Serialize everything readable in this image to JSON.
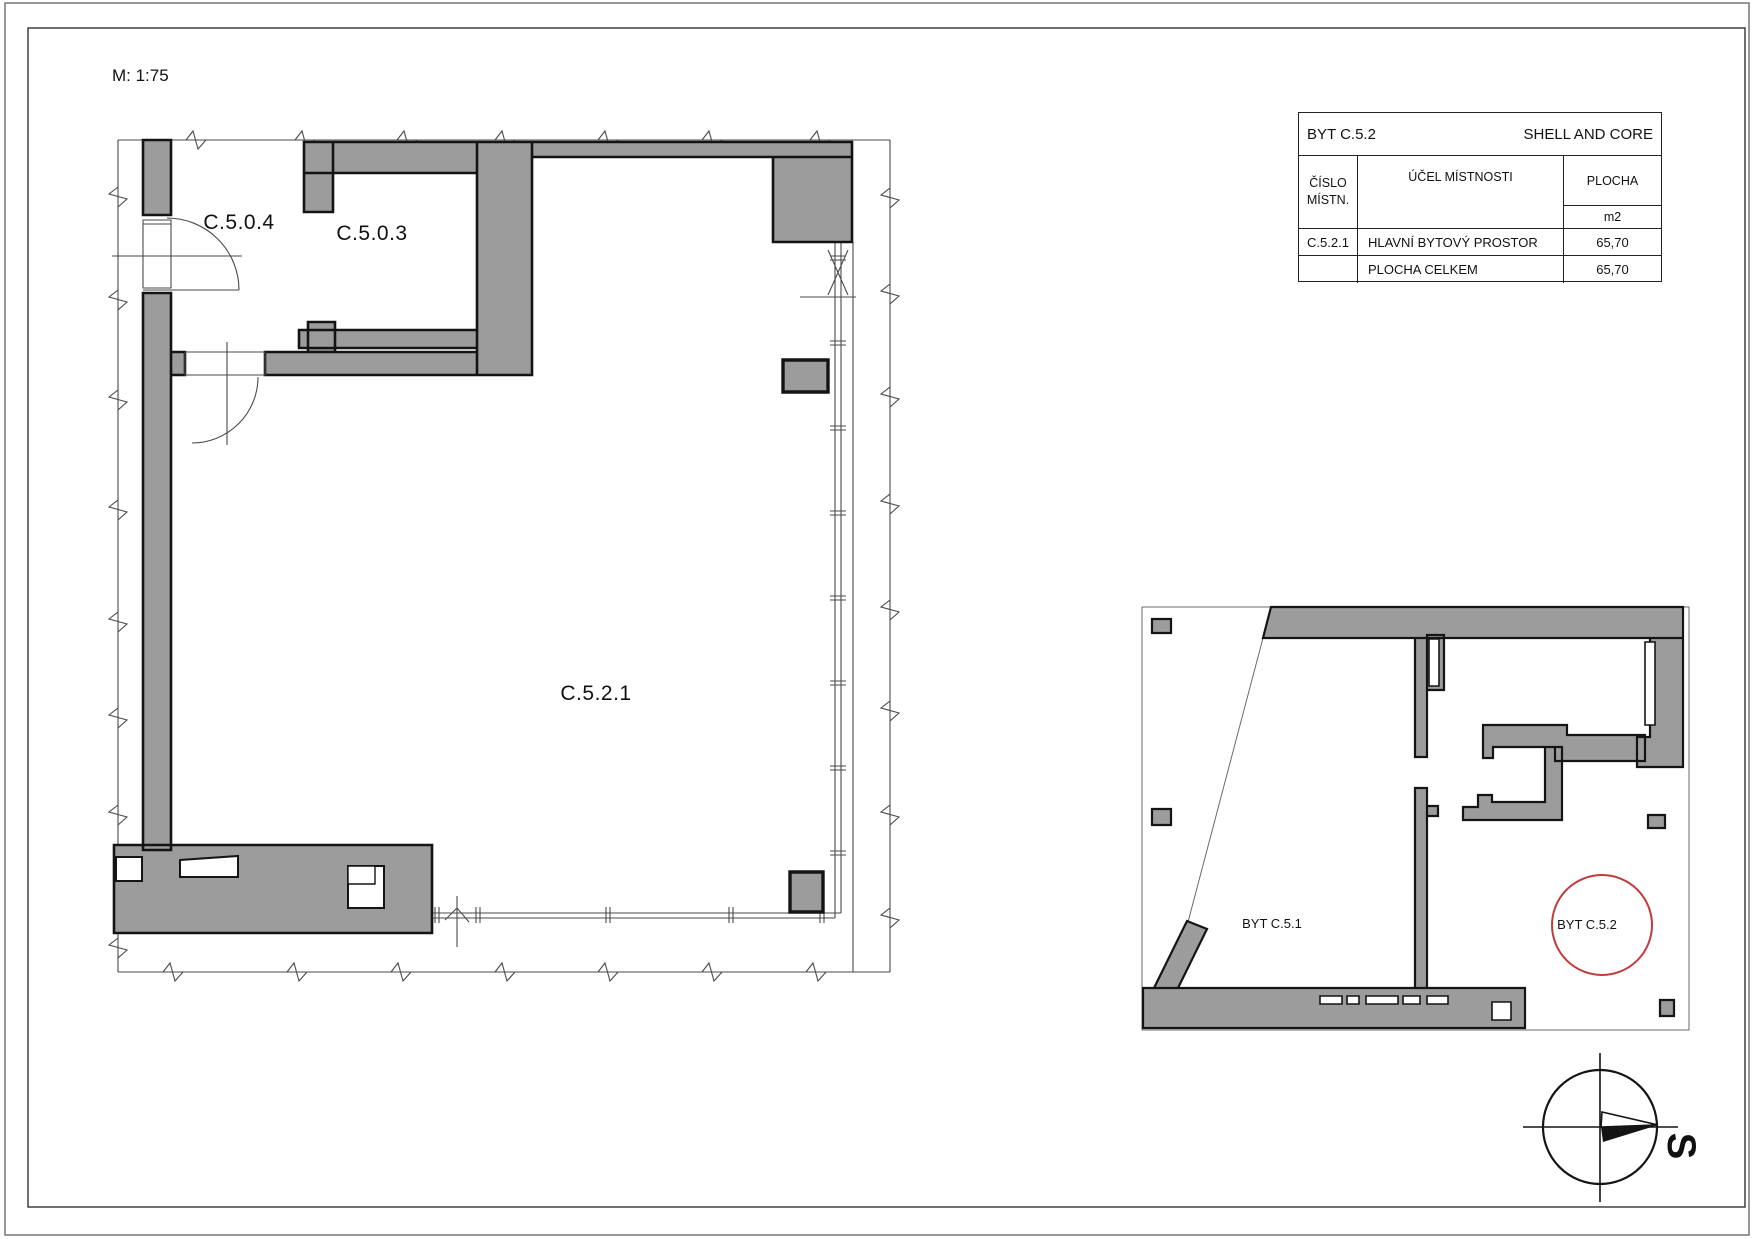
{
  "page": {
    "scale_label": "M: 1:75"
  },
  "colors": {
    "wall_fill": "#9c9c9c",
    "outline": "#141414",
    "thin_line": "#4a4a4a",
    "highlight_red": "#c23b3c"
  },
  "main_plan": {
    "rooms": [
      {
        "id": "C.5.0.4"
      },
      {
        "id": "C.5.0.3"
      },
      {
        "id": "C.5.2.1"
      }
    ]
  },
  "room_table": {
    "title_left": "BYT C.5.2",
    "title_right": "SHELL AND CORE",
    "col_number_line1": "ČÍSLO",
    "col_number_line2": "MÍSTN.",
    "col_purpose": "ÚČEL MÍSTNOSTI",
    "col_area": "PLOCHA",
    "col_area_unit": "m2",
    "rows": [
      {
        "number": "C.5.2.1",
        "purpose": "HLAVNÍ BYTOVÝ PROSTOR",
        "area": "65,70"
      }
    ],
    "total_label": "PLOCHA CELKEM",
    "total_area": "65,70"
  },
  "key_plan": {
    "units": [
      {
        "label": "BYT C.5.1"
      },
      {
        "label": "BYT C.5.2"
      }
    ]
  },
  "compass": {
    "north_label": "S"
  }
}
